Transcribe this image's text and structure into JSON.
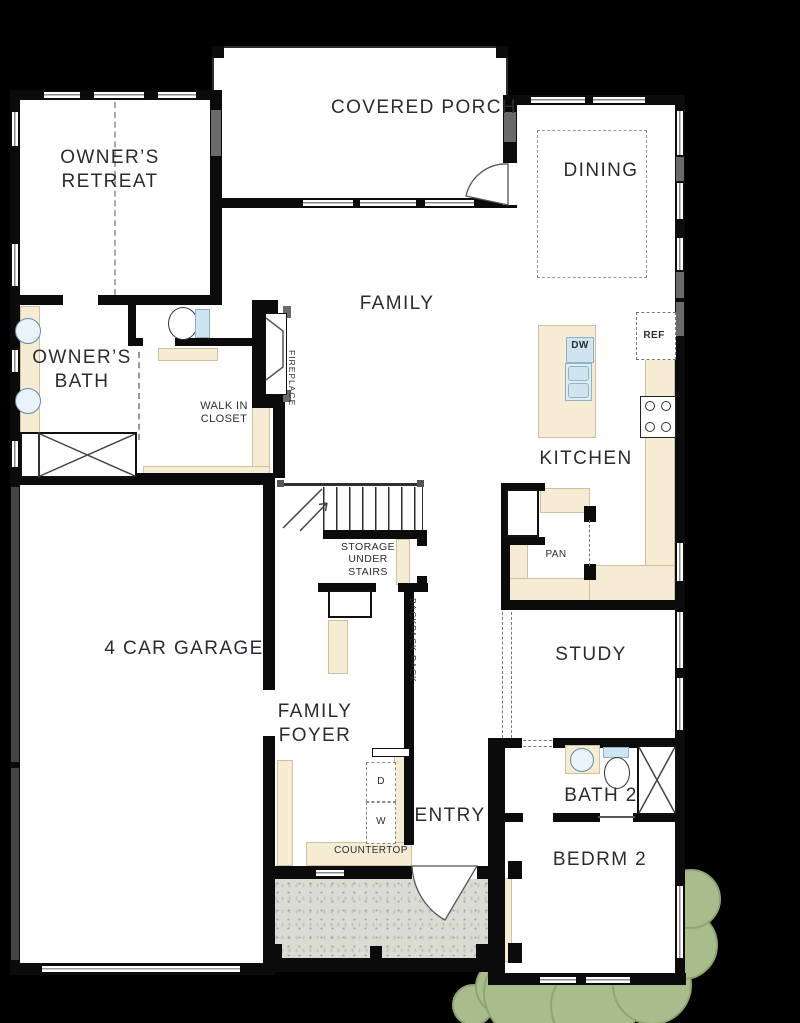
{
  "title": "Single-story floor plan",
  "labels": {
    "covered_porch": "COVERED PORCH",
    "owners_retreat": "OWNER’S RETREAT",
    "dining": "DINING",
    "family": "FAMILY",
    "owners_bath": "OWNER’S\nBATH",
    "walk_in_closet": "WALK IN\nCLOSET",
    "fireplace": "FIREPLACE",
    "kitchen": "KITCHEN",
    "dishwasher": "DW",
    "refrigerator": "REF",
    "pantry": "PAN",
    "storage_under_stairs": "STORAGE\nUNDER\nSTAIRS",
    "garage": "4 CAR GARAGE",
    "study": "STUDY",
    "family_foyer": "FAMILY\nFOYER",
    "backpack_rack": "BACKPACK RACK",
    "entry": "ENTRY",
    "bath2": "BATH 2",
    "bedrm2": "BEDRM 2",
    "countertop": "COUNTERTOP",
    "dryer": "D",
    "washer": "W"
  },
  "colors": {
    "background": "#000000",
    "wall": "#0b0b0b",
    "floor": "#ffffff",
    "counter": "#f6ecd4",
    "fixture_blue": "#cfe4f0",
    "porch_concrete": "#dbdbd5",
    "shrub_green": "#a9bd8c",
    "label_text": "#2b2b33"
  }
}
